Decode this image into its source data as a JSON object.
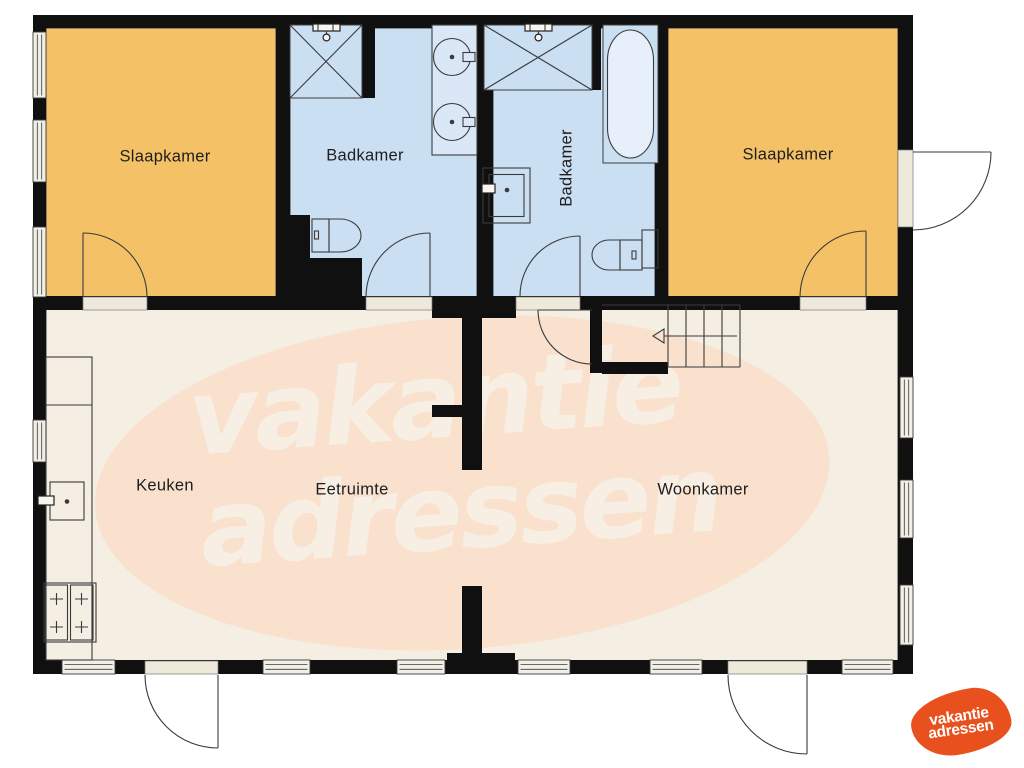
{
  "rooms": {
    "bedroom_left": "Slaapkamer",
    "bathroom_left": "Badkamer",
    "bathroom_right": "Badkamer",
    "bedroom_right": "Slaapkamer",
    "kitchen": "Keuken",
    "dining": "Eetruimte",
    "living": "Woonkamer"
  },
  "watermark": {
    "line1": "vakantie",
    "line2": "adressen"
  },
  "logo": {
    "line1": "vakantie",
    "line2": "adressen"
  },
  "colors": {
    "bedroom-fill": "#f5c167",
    "bathroom-fill": "#cbdff2",
    "floor-fill": "#f4eee3",
    "wall": "#101010",
    "watermark-blob": "#f9e1ce",
    "watermark-text": "#f8f1e6",
    "logo-orange": "#e8511d"
  }
}
